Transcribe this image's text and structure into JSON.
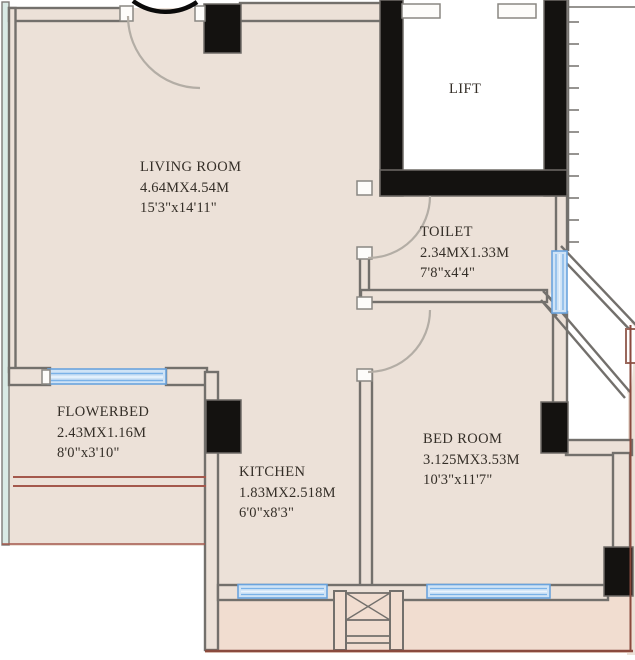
{
  "plan": {
    "type": "residential-floor-plan",
    "colors": {
      "floor": "#ece1d8",
      "terrace": "#f1ddd0",
      "wall_gray": "#73706c",
      "column_black": "#141210",
      "window_blue": "#6aa3dd",
      "window_fill": "#cfe3f6",
      "teal_strip": "#d9eae5",
      "brown_line": "#a4584c",
      "terrace_border": "#8a4a3e"
    }
  },
  "rooms": [
    {
      "id": "living-room",
      "name": "LIVING ROOM",
      "dim_m": "4.64MX4.54M",
      "dim_ft": "15'3\"x14'11\""
    },
    {
      "id": "lift",
      "name": "LIFT",
      "dim_m": "",
      "dim_ft": ""
    },
    {
      "id": "toilet",
      "name": "TOILET",
      "dim_m": "2.34MX1.33M",
      "dim_ft": "7'8\"x4'4\""
    },
    {
      "id": "flowerbed",
      "name": "FLOWERBED",
      "dim_m": "2.43MX1.16M",
      "dim_ft": "8'0\"x3'10\""
    },
    {
      "id": "kitchen",
      "name": "KITCHEN",
      "dim_m": "1.83MX2.518M",
      "dim_ft": "6'0\"x8'3\""
    },
    {
      "id": "bed-room",
      "name": "BED ROOM",
      "dim_m": "3.125MX3.53M",
      "dim_ft": "10'3\"x11'7\""
    }
  ]
}
